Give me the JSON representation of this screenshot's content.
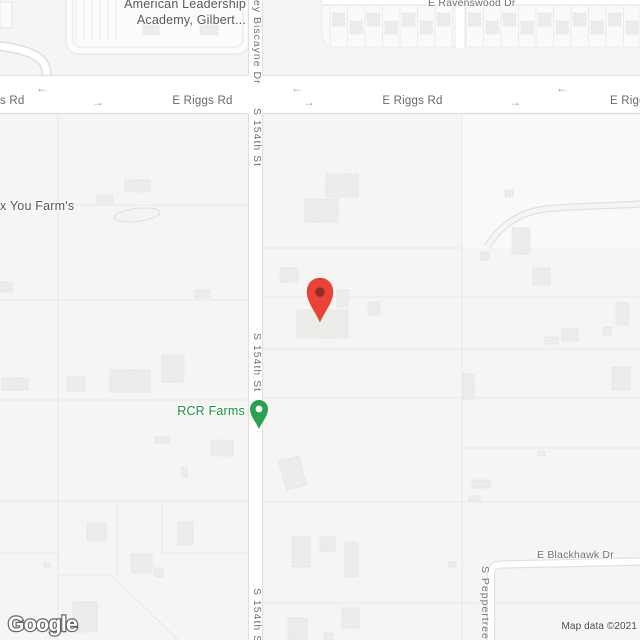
{
  "map": {
    "logo": "Google",
    "attribution": "Map data ©2021",
    "labels": {
      "school_line1": "American Leadership",
      "school_line2": "Academy, Gilbert...",
      "ravenswood": "E Ravenswood Dr",
      "riggs_left": "s Rd",
      "riggs_center": "E Riggs Rd",
      "riggs_east": "E Riggs Rd",
      "riggs_right": "E Riggs",
      "biscayne": "ey Biscayne Dr",
      "s154_upper": "S 154th St",
      "s154_mid": "S 154th St",
      "s154_lower": "S 154th St",
      "farm": "x You Farm's",
      "rcr": "RCR Farms",
      "blackhawk": "E Blackhawk Dr",
      "peppertree": "S Peppertree D"
    },
    "arrows": {
      "left": "←",
      "right": "→"
    },
    "markers": {
      "destination": {
        "color": "#ea4335",
        "dot": "#8f2a20"
      },
      "rcr": {
        "color": "#2aa051",
        "stroke": "#1b7a3d",
        "dot": "#ffffff"
      }
    },
    "colors": {
      "background": "#f5f5f3",
      "road_fill": "#ffffff",
      "road_edge": "#dfdfdd",
      "parcel_line": "#e7e7e5",
      "building_fill": "#ececea",
      "poi_text_green": "#1e8e44",
      "road_label_gray": "#6e7175",
      "area_label_gray": "#54575b"
    }
  }
}
